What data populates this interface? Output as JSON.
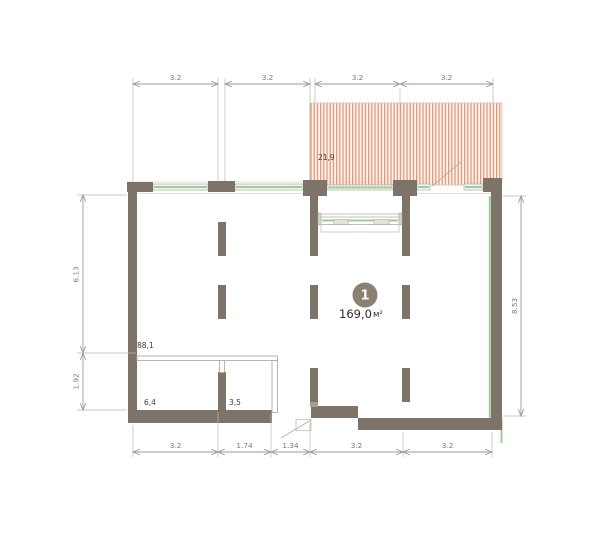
{
  "plan": {
    "room_number": "1",
    "main_area_value": "169,0",
    "area_unit": "м²",
    "terrace_area": "21,9",
    "upper_zone_area": "88,1",
    "lower_left_room_area": "6,4",
    "lower_right_room_area": "3,5"
  },
  "dimensions": {
    "top": [
      "3.2",
      "3.2",
      "3.2",
      "3.2"
    ],
    "bottom": [
      "3.2",
      "1.74",
      "1.34",
      "3.2",
      "3.2"
    ],
    "left": [
      "6.13",
      "1.92"
    ],
    "right": [
      "8.53"
    ]
  },
  "colors": {
    "wall": "#7d7368",
    "partition": "#b3aca4",
    "glass_green": "#9ccd99",
    "hatch_stripe": "#e8906b",
    "hatch_bg": "#fdf3ef",
    "dim_line": "#a29b92",
    "dim_text": "#7e7870",
    "label_text": "#413c36",
    "badge_fill": "#8b8073",
    "badge_text": "#ffffff"
  }
}
